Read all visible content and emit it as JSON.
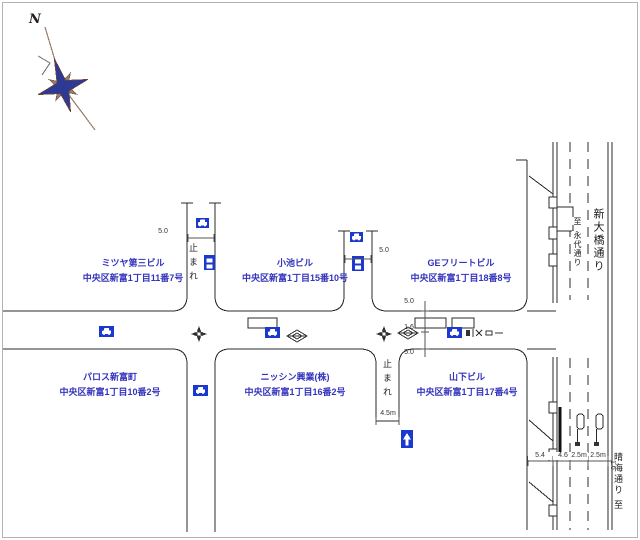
{
  "compass": {
    "north_label": "N"
  },
  "buildings": [
    {
      "name": "ミツヤ第三ビル",
      "address": "中央区新富1丁目11番7号"
    },
    {
      "name": "小池ビル",
      "address": "中央区新富1丁目15番10号"
    },
    {
      "name": "GEフリートビル",
      "address": "中央区新富1丁目18番8号"
    },
    {
      "name": "パロス新富町",
      "address": "中央区新富1丁目10番2号"
    },
    {
      "name": "ニッシン興業(株)",
      "address": "中央区新富1丁目16番2号"
    },
    {
      "name": "山下ビル",
      "address": "中央区新富1丁目17番4号"
    }
  ],
  "streets": {
    "avenue_name": "新大橋通り",
    "north_destination": {
      "prefix": "至",
      "name": "永代通り"
    },
    "south_destination": {
      "name": "晴海通り",
      "suffix": "至"
    }
  },
  "road_markings": {
    "stop_marking": "止まれ"
  },
  "dimensions": {
    "street_a_width": "5.0",
    "street_b_width": "5.0",
    "cross_section": {
      "top": "5.0",
      "middle": "1.6",
      "bottom": "5.0"
    },
    "alley_width": "4.5m",
    "bottom_section": {
      "side_street": "5.4",
      "lane_west": "4.6",
      "lane_center": "2.5m",
      "lane_east": "2.5m",
      "edge": "1.6"
    }
  },
  "colors": {
    "sign_blue": "#1c39cf",
    "label_blue": "#3333bb",
    "compass_blue": "#2c3a96",
    "compass_brown": "#9b7d6b",
    "line": "#2b2b2b"
  }
}
